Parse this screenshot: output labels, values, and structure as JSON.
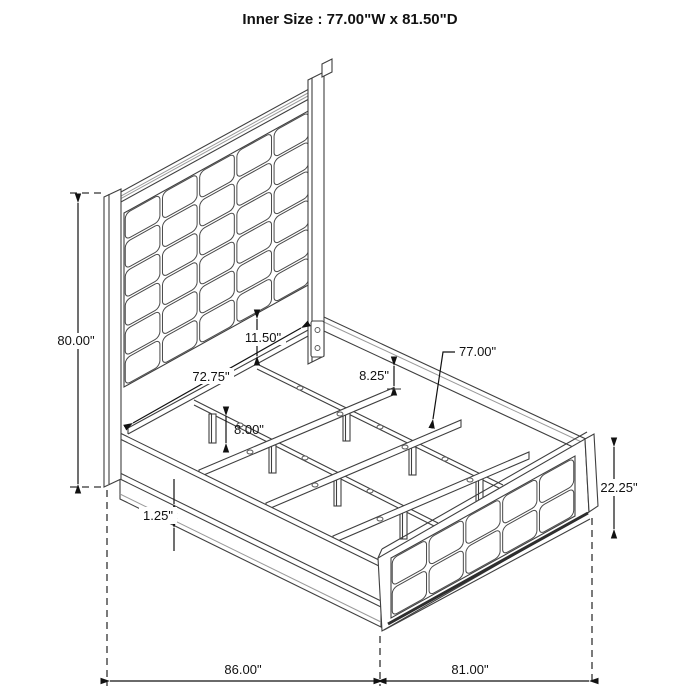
{
  "title": "Inner Size : 77.00\"W x 81.50\"D",
  "dimensions": {
    "overall_height": "80.00\"",
    "headboard_panel_gap": "11.50\"",
    "headboard_inner_width": "72.75\"",
    "rail_to_slat_drop": "8.25\"",
    "slat_length": "77.00\"",
    "leg_height": "8.00\"",
    "rail_lip": "1.25\"",
    "footboard_height": "22.25\"",
    "overall_depth": "86.00\"",
    "overall_width": "81.00\""
  },
  "colors": {
    "line": "#3f3f3f",
    "shade": "#9a9a9a",
    "dimension": "#111111",
    "background": "#ffffff"
  },
  "drawing": {
    "headboard_grid": {
      "cols": 5,
      "rows": 6
    },
    "footboard_grid": {
      "cols": 5,
      "rows": 2
    }
  }
}
